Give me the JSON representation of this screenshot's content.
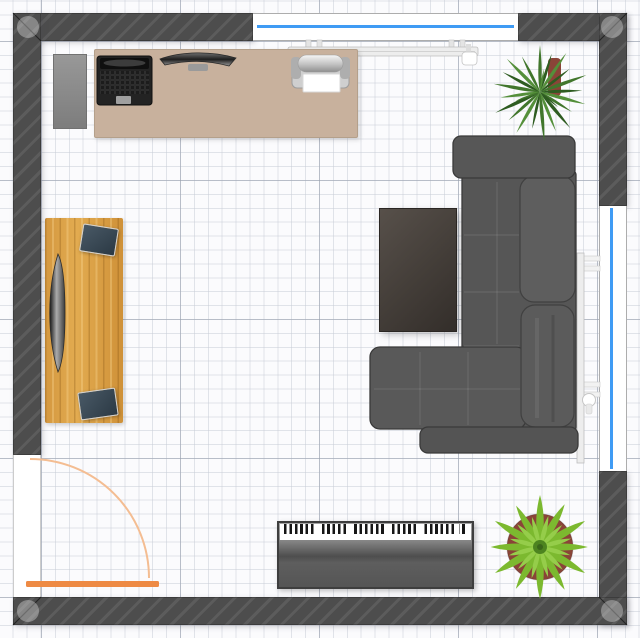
{
  "canvas": {
    "kind": "floor-plan-top-view",
    "width": 640,
    "height": 638
  },
  "palette": {
    "bg": "#fbfbfd",
    "wall": "#4d4d4d",
    "wall_hatch": "rgba(255,255,255,0.085)",
    "grid_minor": "rgba(198,203,213,0.5)",
    "grid_major": "rgba(150,158,172,0.55)",
    "glass": "#3f9bf4",
    "frame": "#adadad",
    "door": "#ee8a44",
    "door_arc": "#f4bd92",
    "desk": "#c8b19d",
    "tv_light": "#57504a",
    "tv_dark": "#332e2a",
    "sofa": "#565656",
    "sofa_dark": "#3a3a3a",
    "piano_dark": "#4e4e4e",
    "key_white": "#ffffff",
    "key_black": "#161616",
    "radiator": "#ededed",
    "radiator_edge": "#bdbdbd",
    "marker": "rgba(255,255,255,0.32)",
    "pot": "#8a4438",
    "plant_a1": "#2e5c21",
    "plant_a2": "#41762c",
    "plant_a3": "#548f3a",
    "plant_b1": "#7cb92f",
    "plant_b2": "#95cd4a",
    "plant_b3": "#4d8420"
  },
  "room": {
    "shape": "square",
    "windows": [
      {
        "wall": "top"
      },
      {
        "wall": "right"
      }
    ],
    "door": {
      "wall": "left",
      "swing": "quarter-arc-inward"
    }
  },
  "furniture": [
    {
      "name": "office-desk"
    },
    {
      "name": "laptop"
    },
    {
      "name": "monitor"
    },
    {
      "name": "printer"
    },
    {
      "name": "cabinet"
    },
    {
      "name": "radiator-top"
    },
    {
      "name": "radiator-right"
    },
    {
      "name": "writing-desk"
    },
    {
      "name": "curved-monitor"
    },
    {
      "name": "tablet-screen-1"
    },
    {
      "name": "tablet-screen-2"
    },
    {
      "name": "tv-screen"
    },
    {
      "name": "sectional-sofa"
    },
    {
      "name": "digital-piano"
    },
    {
      "name": "plant-yucca"
    },
    {
      "name": "plant-star"
    }
  ]
}
